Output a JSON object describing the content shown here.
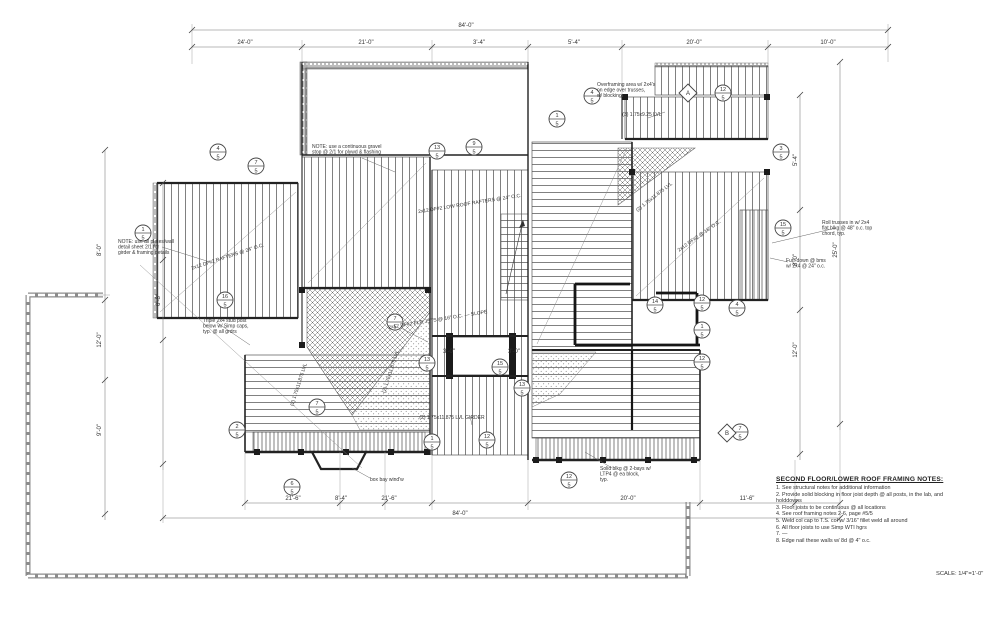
{
  "colors": {
    "ink": "#333333",
    "wall": "#1b1b1b",
    "paper": "#ffffff"
  },
  "sheet": {
    "scale_label": "SCALE: 1/4\"=1'-0\"",
    "notes": {
      "heading": "SECOND FLOOR/LOWER ROOF FRAMING NOTES:",
      "items": [
        "1. See structural notes for additional information",
        "2. Provide solid blocking in floor joist depth @ all posts, in the lab, and holddowns",
        "3. Floor joists to be continuous @ all locations",
        "4. See roof framing notes 2-6, page #5/5",
        "5. Weld col cap to T.S. col w/ 3/16\" fillet weld all around",
        "6. All floor joists to use Simp WTI hgrs",
        "7. —",
        "8. Edge nail these walls w/ 8d @ 4\" o.c."
      ]
    }
  },
  "plan": {
    "dim_labels": [
      {
        "x": 466,
        "y": 27,
        "t": "84'-0\""
      },
      {
        "x": 245,
        "y": 44,
        "t": "24'-0\""
      },
      {
        "x": 366,
        "y": 44,
        "t": "21'-0\""
      },
      {
        "x": 479,
        "y": 44,
        "t": "3'-4\""
      },
      {
        "x": 574,
        "y": 44,
        "t": "5'-4\""
      },
      {
        "x": 694,
        "y": 44,
        "t": "20'-0\""
      },
      {
        "x": 828,
        "y": 44,
        "t": "10'-0\""
      },
      {
        "x": 293,
        "y": 500,
        "t": "21'-6\""
      },
      {
        "x": 341,
        "y": 500,
        "t": "8'-4\""
      },
      {
        "x": 389,
        "y": 500,
        "t": "21'-6\""
      },
      {
        "x": 628,
        "y": 500,
        "t": "20'-0\""
      },
      {
        "x": 747,
        "y": 500,
        "t": "11'-6\""
      },
      {
        "x": 460,
        "y": 515,
        "t": "84'-0\""
      },
      {
        "x": 101,
        "y": 250,
        "t": "8'-0\"",
        "r": -90
      },
      {
        "x": 101,
        "y": 340,
        "t": "12'-0\"",
        "r": -90
      },
      {
        "x": 101,
        "y": 430,
        "t": "9'-0\"",
        "r": -90
      },
      {
        "x": 160,
        "y": 300,
        "t": "6'-8\"",
        "r": -90
      },
      {
        "x": 797,
        "y": 160,
        "t": "5'-4\"",
        "r": -90
      },
      {
        "x": 797,
        "y": 260,
        "t": "8'-0\"",
        "r": -90
      },
      {
        "x": 797,
        "y": 350,
        "t": "12'-0\"",
        "r": -90
      },
      {
        "x": 837,
        "y": 250,
        "t": "25'-0\"",
        "r": -90
      },
      {
        "x": 449,
        "y": 353,
        "t": "3'-0\""
      },
      {
        "x": 514,
        "y": 353,
        "t": "3'-0\""
      }
    ],
    "bubbles": [
      {
        "x": 218,
        "y": 152,
        "n": "4",
        "s": "5"
      },
      {
        "x": 256,
        "y": 166,
        "n": "7",
        "s": "5"
      },
      {
        "x": 437,
        "y": 151,
        "n": "13",
        "s": "5"
      },
      {
        "x": 474,
        "y": 147,
        "n": "9",
        "s": "5"
      },
      {
        "x": 557,
        "y": 119,
        "n": "1",
        "s": "5"
      },
      {
        "x": 592,
        "y": 96,
        "n": "4",
        "s": "5"
      },
      {
        "x": 723,
        "y": 93,
        "n": "12",
        "s": "5"
      },
      {
        "x": 781,
        "y": 152,
        "n": "3",
        "s": "5"
      },
      {
        "x": 783,
        "y": 228,
        "n": "15",
        "s": "5"
      },
      {
        "x": 655,
        "y": 305,
        "n": "14",
        "s": "5"
      },
      {
        "x": 702,
        "y": 303,
        "n": "12",
        "s": "5"
      },
      {
        "x": 737,
        "y": 308,
        "n": "4",
        "s": "5"
      },
      {
        "x": 702,
        "y": 330,
        "n": "1",
        "s": "5"
      },
      {
        "x": 702,
        "y": 362,
        "n": "12",
        "s": "5"
      },
      {
        "x": 740,
        "y": 432,
        "n": "7",
        "s": "5"
      },
      {
        "x": 395,
        "y": 322,
        "n": "7",
        "s": "5"
      },
      {
        "x": 427,
        "y": 363,
        "n": "13",
        "s": "5"
      },
      {
        "x": 500,
        "y": 367,
        "n": "15",
        "s": "5"
      },
      {
        "x": 522,
        "y": 388,
        "n": "13",
        "s": "5"
      },
      {
        "x": 317,
        "y": 407,
        "n": "7",
        "s": "5"
      },
      {
        "x": 237,
        "y": 430,
        "n": "2",
        "s": "5"
      },
      {
        "x": 432,
        "y": 442,
        "n": "1",
        "s": "5"
      },
      {
        "x": 487,
        "y": 440,
        "n": "12",
        "s": "5"
      },
      {
        "x": 569,
        "y": 480,
        "n": "12",
        "s": "5"
      },
      {
        "x": 225,
        "y": 300,
        "n": "16",
        "s": "5"
      },
      {
        "x": 143,
        "y": 233,
        "n": "1",
        "s": "5"
      },
      {
        "x": 292,
        "y": 487,
        "n": "6",
        "s": "5"
      }
    ],
    "diamonds": [
      {
        "x": 688,
        "y": 93,
        "t": "A"
      },
      {
        "x": 727,
        "y": 433,
        "t": "B"
      }
    ],
    "callouts": [
      {
        "x": 118,
        "y": 243,
        "lines": [
          "NOTE: use all plates/wall",
          "detail sheet 2/1 for",
          "girder & framing details"
        ]
      },
      {
        "x": 312,
        "y": 148,
        "lines": [
          "NOTE: use a continuous gravel",
          "stop @ 2/1 for plywd & flashing"
        ]
      },
      {
        "x": 642,
        "y": 116,
        "a": "middle",
        "lines": [
          "(3) 1.75x9.25 LVL"
        ]
      },
      {
        "x": 597,
        "y": 86,
        "lines": [
          "Overframing area w/ 2x4's",
          "on edge over trusses,",
          "w/ blocking"
        ]
      },
      {
        "x": 822,
        "y": 224,
        "lines": [
          "Roll trusses in w/ 2x4",
          "flat blkg @ 48\" o.c. top",
          "chord, typ."
        ]
      },
      {
        "x": 786,
        "y": 262,
        "lines": [
          "Furr down @ bms",
          "w/ 2x4 @ 24\" o.c."
        ]
      },
      {
        "x": 655,
        "y": 198,
        "r": -38,
        "a": "middle",
        "lines": [
          "(2) 1.75x11.875 LVL"
        ]
      },
      {
        "x": 470,
        "y": 205,
        "r": -9,
        "a": "middle",
        "lines": [
          "2x12 DF#2 LOW ROOF RAFTERS @ 24\" O.C."
        ]
      },
      {
        "x": 438,
        "y": 321,
        "r": -9,
        "a": "middle",
        "lines": [
          "2x12 DF#2 FLR JSTS @ 16\" O.C. — SLOPE"
        ]
      },
      {
        "x": 300,
        "y": 385,
        "r": -72,
        "a": "middle",
        "lines": [
          "(2) 1.75x11.875 LVL"
        ]
      },
      {
        "x": 392,
        "y": 372,
        "r": -72,
        "a": "middle",
        "lines": [
          "(2) 1.75x11.875 LVL"
        ]
      },
      {
        "x": 203,
        "y": 322,
        "lines": [
          "Triple 2x4 stud post",
          "below w/ Simp caps,",
          "typ. @ all grdrs"
        ]
      },
      {
        "x": 600,
        "y": 470,
        "lines": [
          "Solid blkg @ 2-bays w/",
          "LTP4 @ ea block,",
          "typ."
        ]
      },
      {
        "x": 370,
        "y": 481,
        "lines": [
          "box bay wind'w"
        ]
      },
      {
        "x": 452,
        "y": 419,
        "a": "middle",
        "lines": [
          "(2) 1.75x11.875 LVL GIRDER"
        ]
      },
      {
        "x": 228,
        "y": 258,
        "r": -18,
        "a": "middle",
        "lines": [
          "2x12 DF#2 RAFTERS @ 24\" O.C."
        ]
      },
      {
        "x": 700,
        "y": 237,
        "r": -35,
        "a": "middle",
        "lines": [
          "2x12 DF#2 @ 16\" O.C."
        ]
      }
    ]
  }
}
